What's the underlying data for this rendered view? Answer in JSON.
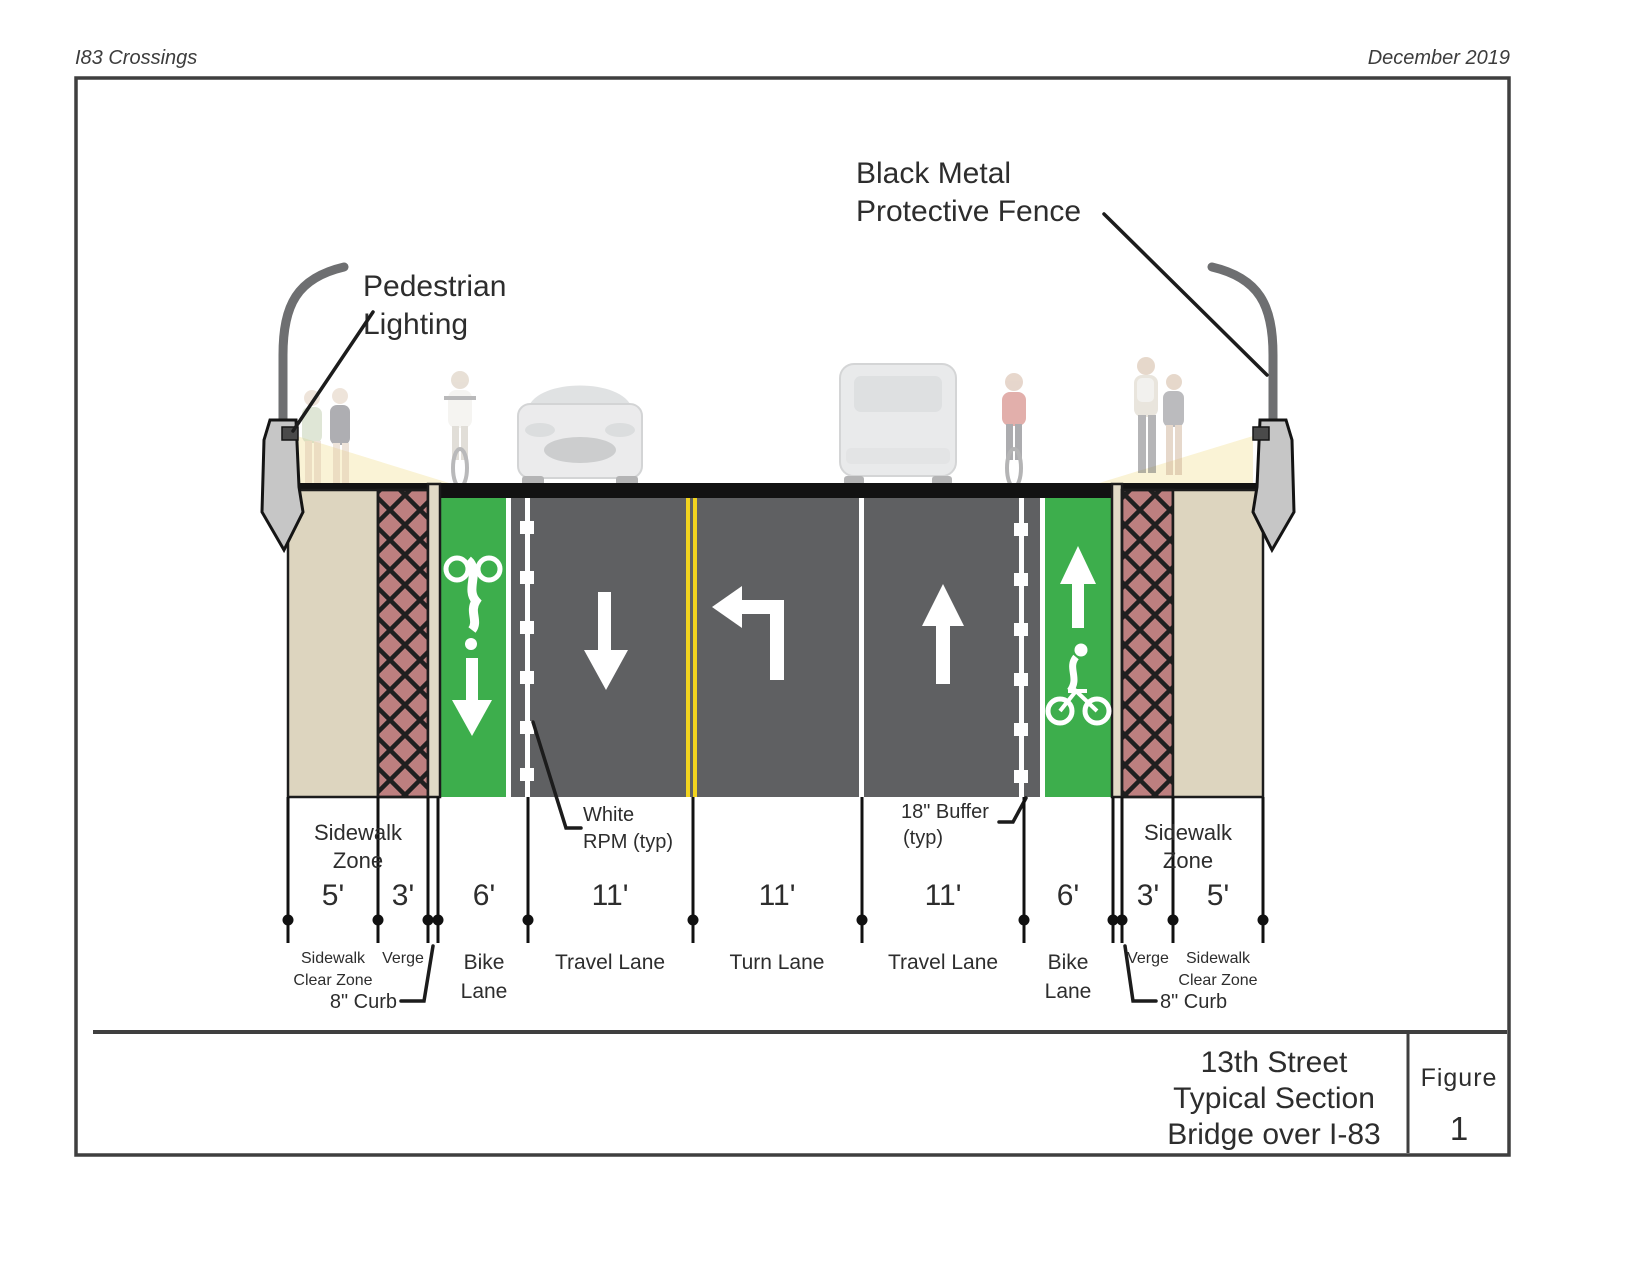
{
  "page": {
    "header_left": "I83 Crossings",
    "header_right": "December 2019"
  },
  "annotations": {
    "fence_label_line1": "Black Metal",
    "fence_label_line2": "Protective Fence",
    "lighting_label_line1": "Pedestrian",
    "lighting_label_line2": "Lighting",
    "rpm_label_line1": "White",
    "rpm_label_line2": "RPM (typ)",
    "buffer_label_line1": "18\" Buffer",
    "buffer_label_line2": "(typ)",
    "curb_label_left": "8\" Curb",
    "curb_label_right": "8\" Curb",
    "sidewalk_zone_left_line1": "Sidewalk",
    "sidewalk_zone_left_line2": "Zone",
    "sidewalk_zone_right_line1": "Sidewalk",
    "sidewalk_zone_right_line2": "Zone"
  },
  "dimensions": [
    {
      "width": "5'",
      "name_line1": "Sidewalk",
      "name_line2": "Clear Zone"
    },
    {
      "width": "3'",
      "name_line1": "Verge",
      "name_line2": ""
    },
    {
      "width": "6'",
      "name_line1": "Bike",
      "name_line2": "Lane"
    },
    {
      "width": "11'",
      "name_line1": "Travel Lane",
      "name_line2": ""
    },
    {
      "width": "11'",
      "name_line1": "Turn Lane",
      "name_line2": ""
    },
    {
      "width": "11'",
      "name_line1": "Travel Lane",
      "name_line2": ""
    },
    {
      "width": "6'",
      "name_line1": "Bike",
      "name_line2": "Lane"
    },
    {
      "width": "3'",
      "name_line1": "Verge",
      "name_line2": ""
    },
    {
      "width": "5'",
      "name_line1": "Sidewalk",
      "name_line2": "Clear Zone"
    }
  ],
  "title_block": {
    "line1": "13th Street",
    "line2": "Typical Section",
    "line3": "Bridge over I-83",
    "figure_label": "Figure",
    "figure_number": "1"
  },
  "colors": {
    "road": "#5f6062",
    "bike_lane": "#3dae4c",
    "verge": "#bd7f7f",
    "sidewalk": "#ddd5bf",
    "curb": "#e1dac6",
    "centerline": "#f1d31f",
    "light_cone": "#faf3d6",
    "deck": "#121212"
  }
}
